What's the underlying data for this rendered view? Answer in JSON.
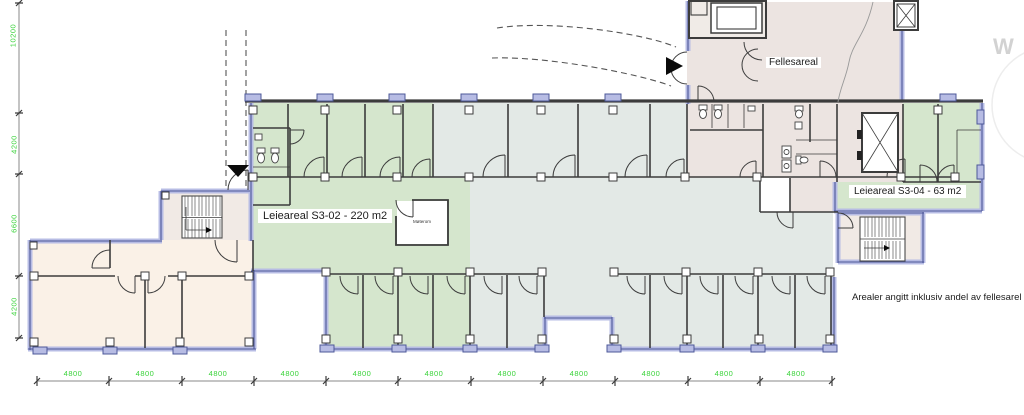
{
  "labels": {
    "fellesareal": "Fellesareal",
    "s302": "Leieareal S3-02 - 220 m2",
    "moterom": "Møterom",
    "s304": "Leieareal S3-04 - 63 m2",
    "note": "Arealer angitt inklusiv andel av fellesarel",
    "watermark": "W"
  },
  "dims": {
    "left": [
      "10200",
      "4200",
      "6600",
      "4200"
    ],
    "bottom": [
      "4800",
      "4800",
      "4800",
      "4800",
      "4800",
      "4800",
      "4800",
      "4800",
      "4800",
      "4800",
      "4800"
    ]
  },
  "colors": {
    "area-green": "#d5e6cd",
    "area-gray": "#e3e9e6",
    "area-beige": "#faf1e7",
    "area-pink": "#ece4e1",
    "area-stair": "#f1eae5",
    "wall-dark": "#3c3c3c",
    "wall-blue-fill": "#b7bce4",
    "wall-blue-edge": "#4d5899",
    "dim-green": "#3bd33b",
    "dim-line": "#8a8a8a",
    "dash": "#555555",
    "watermark": "#d2d2d2",
    "fixture": "#444444"
  }
}
